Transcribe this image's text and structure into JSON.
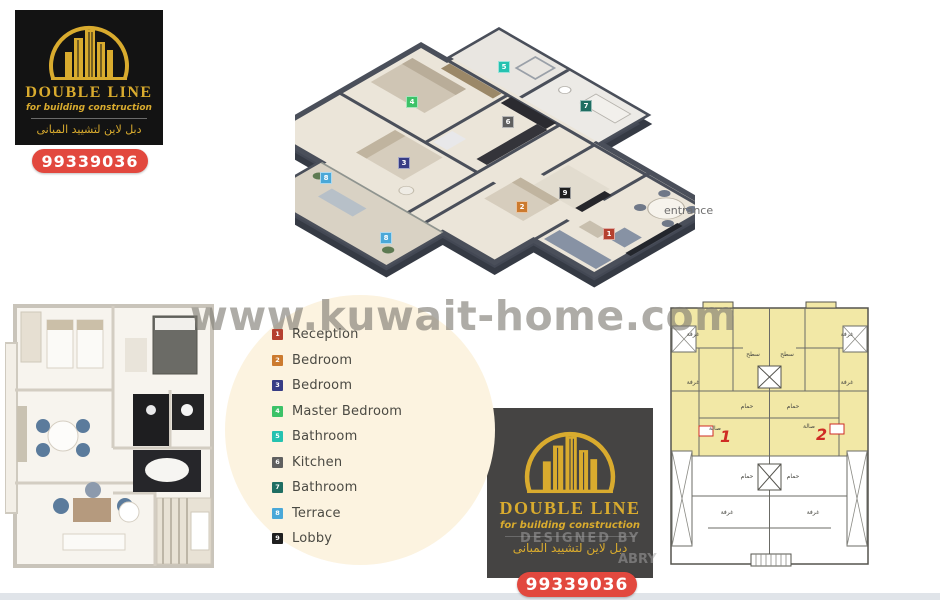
{
  "page": {
    "watermark": "www.kuwait-home.com",
    "background_color": "#ffffff",
    "accent_cream_circle": "#fcf3e0"
  },
  "brand": {
    "name": "DOUBLE LINE",
    "tagline": "for building construction",
    "tagline_ar": "دبل لاين لتشييد المبانى",
    "phone": "99339036",
    "gold": "#d9ab2e",
    "red": "#e2483e"
  },
  "designer_watermark": {
    "line1": "DESIGNED BY",
    "line2": "ABRY"
  },
  "plan3d": {
    "entrance_label": "entrance",
    "badges": [
      {
        "n": "1",
        "room": "Reception",
        "color": "#b5402f"
      },
      {
        "n": "2",
        "room": "Bedroom",
        "color": "#cc7a2e"
      },
      {
        "n": "3",
        "room": "Bedroom",
        "color": "#373c85"
      },
      {
        "n": "4",
        "room": "Master Bedroom",
        "color": "#3cc268"
      },
      {
        "n": "5",
        "room": "Bathroom",
        "color": "#25c2b0"
      },
      {
        "n": "6",
        "room": "Kitchen",
        "color": "#5f5f5f"
      },
      {
        "n": "7",
        "room": "Bathroom",
        "color": "#1f6e62"
      },
      {
        "n": "8",
        "room": "Terrace",
        "color": "#4aa8d8"
      },
      {
        "n": "8b",
        "room": "Terrace",
        "color": "#4aa8d8",
        "n_display": "8"
      },
      {
        "n": "9",
        "room": "Lobby",
        "color": "#1f1f1f"
      }
    ]
  },
  "legend": {
    "items": [
      {
        "n": "1",
        "label": "Reception",
        "color": "#b5402f"
      },
      {
        "n": "2",
        "label": "Bedroom",
        "color": "#cc7a2e"
      },
      {
        "n": "3",
        "label": "Bedroom",
        "color": "#373c85"
      },
      {
        "n": "4",
        "label": "Master Bedroom",
        "color": "#3cc268"
      },
      {
        "n": "5",
        "label": "Bathroom",
        "color": "#25c2b0"
      },
      {
        "n": "6",
        "label": "Kitchen",
        "color": "#5f5f5f"
      },
      {
        "n": "7",
        "label": "Bathroom",
        "color": "#1f6e62"
      },
      {
        "n": "8",
        "label": "Terrace",
        "color": "#4aa8d8"
      },
      {
        "n": "9",
        "label": "Lobby",
        "color": "#1f1f1f"
      }
    ]
  },
  "plan2d": {
    "unit1": "1",
    "unit2": "2",
    "highlight_color": "#f2e8a6",
    "labels": {
      "roof": "سطح",
      "bath": "حمام",
      "hall": "صالة",
      "room": "غرفة"
    }
  }
}
